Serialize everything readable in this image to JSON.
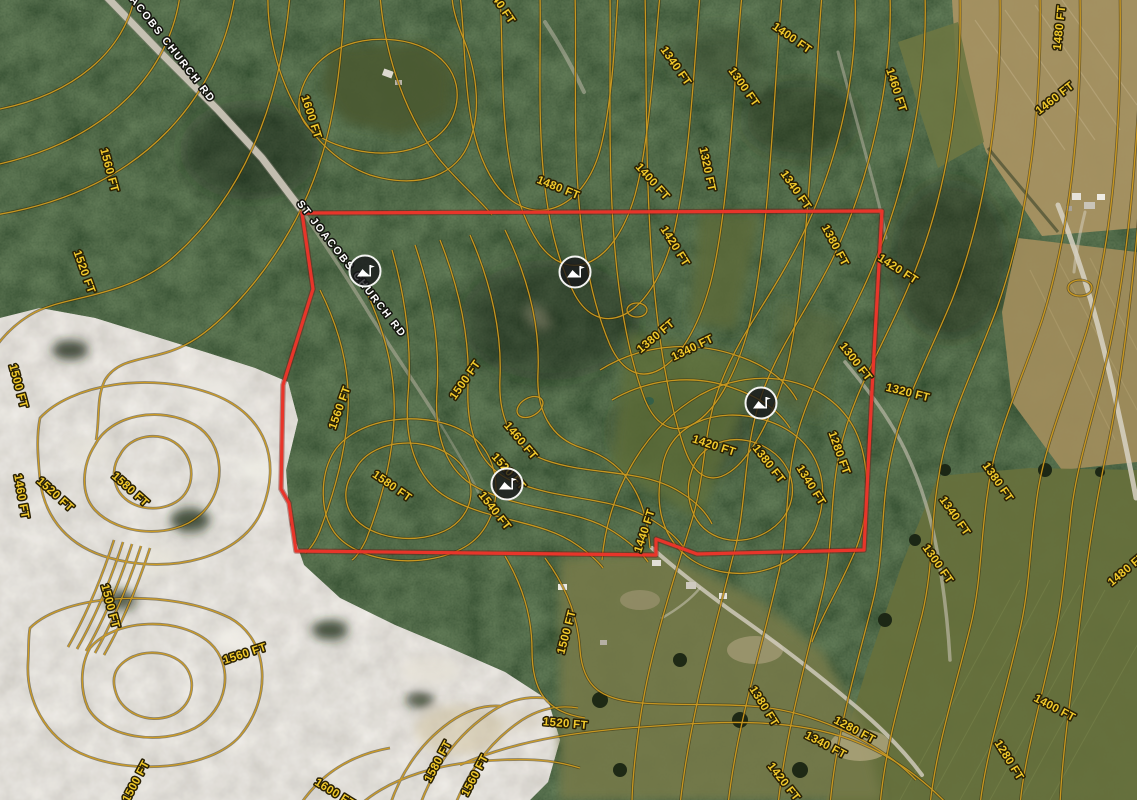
{
  "map": {
    "type": "aerial-imagery-with-contours",
    "contour_interval_ft": 20,
    "colors": {
      "contour_line": "#cf9c20",
      "contour_label": "#f2ca2c",
      "boundary": "#e8352a",
      "road_label": "#ffffff"
    },
    "boundary": {
      "color": "#e8352a",
      "points": "302,213 882,211 872,390 864,550 697,554 656,539 656,555 296,551 289,503 281,489 283,385 313,289"
    },
    "road_labels": [
      {
        "text": "ST JOACOBS CHURCH RD",
        "x": 158,
        "y": 36,
        "rotation": 52
      },
      {
        "text": "ST JOACOBS CHURCH RD",
        "x": 349,
        "y": 271,
        "rotation": 52
      }
    ],
    "markers": [
      {
        "name": "elevation-point",
        "x": 365,
        "y": 271
      },
      {
        "name": "elevation-point",
        "x": 575,
        "y": 272
      },
      {
        "name": "elevation-point",
        "x": 761,
        "y": 403
      },
      {
        "name": "elevation-point",
        "x": 507,
        "y": 484
      }
    ],
    "contour_labels": [
      {
        "text": "1600 FT",
        "x": 308,
        "y": 118,
        "rotation": 72
      },
      {
        "text": "1440 FT",
        "x": 497,
        "y": 6,
        "rotation": 56
      },
      {
        "text": "1480 FT",
        "x": 557,
        "y": 191,
        "rotation": 22
      },
      {
        "text": "1400 FT",
        "x": 650,
        "y": 184,
        "rotation": 48
      },
      {
        "text": "1340 FT",
        "x": 673,
        "y": 68,
        "rotation": 55
      },
      {
        "text": "1320 FT",
        "x": 704,
        "y": 170,
        "rotation": 78
      },
      {
        "text": "1300 FT",
        "x": 741,
        "y": 89,
        "rotation": 55
      },
      {
        "text": "1400 FT",
        "x": 790,
        "y": 41,
        "rotation": 35
      },
      {
        "text": "1460 FT",
        "x": 893,
        "y": 91,
        "rotation": 72
      },
      {
        "text": "1480 FT",
        "x": 1063,
        "y": 28,
        "rotation": -84
      },
      {
        "text": "1460 FT",
        "x": 1057,
        "y": 101,
        "rotation": -38
      },
      {
        "text": "1340 FT",
        "x": 793,
        "y": 192,
        "rotation": 55
      },
      {
        "text": "1420 FT",
        "x": 896,
        "y": 272,
        "rotation": 33
      },
      {
        "text": "1320 FT",
        "x": 907,
        "y": 396,
        "rotation": 14
      },
      {
        "text": "1300 FT",
        "x": 853,
        "y": 364,
        "rotation": 52
      },
      {
        "text": "1420 FT",
        "x": 672,
        "y": 248,
        "rotation": 58
      },
      {
        "text": "1380 FT",
        "x": 832,
        "y": 247,
        "rotation": 62
      },
      {
        "text": "1380 FT",
        "x": 658,
        "y": 339,
        "rotation": -40
      },
      {
        "text": "1340 FT",
        "x": 694,
        "y": 351,
        "rotation": -26
      },
      {
        "text": "1560 FT",
        "x": 343,
        "y": 409,
        "rotation": -70
      },
      {
        "text": "1500 FT",
        "x": 468,
        "y": 382,
        "rotation": -55
      },
      {
        "text": "1460 FT",
        "x": 518,
        "y": 443,
        "rotation": 50
      },
      {
        "text": "1520 FT",
        "x": 506,
        "y": 474,
        "rotation": 48
      },
      {
        "text": "1540 FT",
        "x": 492,
        "y": 513,
        "rotation": 52
      },
      {
        "text": "1440 FT",
        "x": 648,
        "y": 532,
        "rotation": -72
      },
      {
        "text": "1420 FT",
        "x": 713,
        "y": 449,
        "rotation": 18
      },
      {
        "text": "1380 FT",
        "x": 766,
        "y": 466,
        "rotation": 52
      },
      {
        "text": "1340 FT",
        "x": 808,
        "y": 487,
        "rotation": 58
      },
      {
        "text": "1280 FT",
        "x": 836,
        "y": 454,
        "rotation": 70
      },
      {
        "text": "1380 FT",
        "x": 995,
        "y": 484,
        "rotation": 55
      },
      {
        "text": "1340 FT",
        "x": 952,
        "y": 518,
        "rotation": 55
      },
      {
        "text": "1300 FT",
        "x": 935,
        "y": 566,
        "rotation": 55
      },
      {
        "text": "1560 FT",
        "x": 106,
        "y": 171,
        "rotation": 75
      },
      {
        "text": "1520 FT",
        "x": 81,
        "y": 273,
        "rotation": 70
      },
      {
        "text": "1500 FT",
        "x": 15,
        "y": 387,
        "rotation": 75
      },
      {
        "text": "1460 FT",
        "x": 18,
        "y": 497,
        "rotation": 80
      },
      {
        "text": "1520 FT",
        "x": 53,
        "y": 497,
        "rotation": 42
      },
      {
        "text": "1580 FT",
        "x": 128,
        "y": 492,
        "rotation": 42
      },
      {
        "text": "1580 FT",
        "x": 390,
        "y": 489,
        "rotation": 35
      },
      {
        "text": "1500 FT",
        "x": 107,
        "y": 607,
        "rotation": 75
      },
      {
        "text": "1560 FT",
        "x": 246,
        "y": 657,
        "rotation": -18
      },
      {
        "text": "1500 FT",
        "x": 570,
        "y": 633,
        "rotation": -75
      },
      {
        "text": "1520 FT",
        "x": 565,
        "y": 727,
        "rotation": 5
      },
      {
        "text": "1580 FT",
        "x": 441,
        "y": 763,
        "rotation": -62
      },
      {
        "text": "1560 FT",
        "x": 478,
        "y": 777,
        "rotation": -62
      },
      {
        "text": "1600 FT",
        "x": 333,
        "y": 796,
        "rotation": 32
      },
      {
        "text": "1500 FT",
        "x": 139,
        "y": 783,
        "rotation": -62
      },
      {
        "text": "1380 FT",
        "x": 761,
        "y": 708,
        "rotation": 58
      },
      {
        "text": "1340 FT",
        "x": 824,
        "y": 748,
        "rotation": 28
      },
      {
        "text": "1280 FT",
        "x": 853,
        "y": 733,
        "rotation": 28
      },
      {
        "text": "1400 FT",
        "x": 1053,
        "y": 711,
        "rotation": 28
      },
      {
        "text": "1280 FT",
        "x": 1006,
        "y": 762,
        "rotation": 58
      },
      {
        "text": "1420 FT",
        "x": 781,
        "y": 784,
        "rotation": 52
      },
      {
        "text": "1480 FT",
        "x": 1129,
        "y": 572,
        "rotation": -40
      }
    ]
  }
}
